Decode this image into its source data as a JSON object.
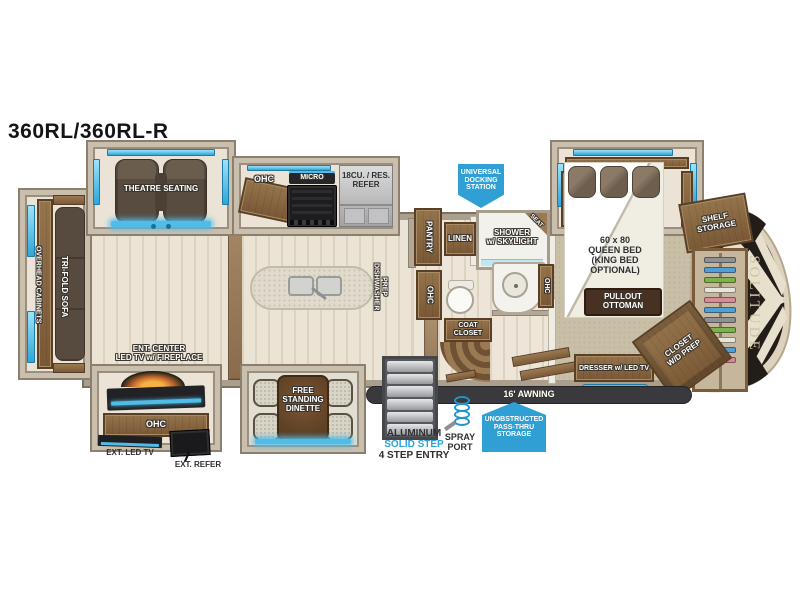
{
  "title": "360RL/360RL-R",
  "brand": {
    "name": "SOLITUDE"
  },
  "colors": {
    "accent_blue": "#4fbde8",
    "badge_blue": "#2f9fd4",
    "wall": "#aa9e8c",
    "frame": "#cabead",
    "wood_floor": "#ebe4d5",
    "carpet": "#c9bea6",
    "cabinet_wood": "#8a6848",
    "dark_furniture": "#574b3f",
    "cap_black": "#221d18",
    "awning_dark": "#3a3a3e",
    "hanger_colors": [
      "#8b9196",
      "#4d9fd6",
      "#79b34c",
      "#e7e4da",
      "#d68b9b",
      "#4d9fd6",
      "#8b9196",
      "#79b34c",
      "#e7e4da",
      "#4d9fd6",
      "#d68b9b"
    ]
  },
  "labels": {
    "theatre_seating": "THEATRE SEATING",
    "overhead_cabinets": "OVERHEAD CABINETS",
    "tri_fold_sofa": "TRI-FOLD SOFA",
    "ent_center": "ENT. CENTER\nLED TV  w/ FIREPLACE",
    "ohc": "OHC",
    "ext_led_tv": "EXT. LED TV",
    "ext_refer": "EXT. REFER",
    "micro": "MICRO",
    "refer": "18CU. / RES.\nREFER",
    "free_standing_dinette": "FREE\nSTANDING\nDINETTE",
    "dishwasher_prep": "DISHWASHER\nPREP",
    "pantry": "PANTRY",
    "linen": "LINEN",
    "shower": "SHOWER\nw/ SKYLIGHT",
    "seat": "SEAT",
    "coat_closet": "COAT\nCLOSET",
    "queen_bed": "60 x 80\nQUEEN BED\n(KING BED\nOPTIONAL)",
    "pullout_ottoman": "PULLOUT\nOTTOMAN",
    "dresser": "DRESSER w/ LED TV",
    "closet_wd": "CLOSET\nW/D PREP",
    "shelf_storage": "SHELF\nSTORAGE",
    "awning": "16' AWNING",
    "step_material": "ALUMINUM",
    "step_type": "SOLID STEP",
    "step_entry": "4 STEP ENTRY",
    "spray_port": "SPRAY\nPORT"
  },
  "badges": {
    "docking_station": "UNIVERSAL\nDOCKING\nSTATION",
    "passthru_storage": "UNOBSTRUCTED\nPASS-THRU\nSTORAGE"
  }
}
